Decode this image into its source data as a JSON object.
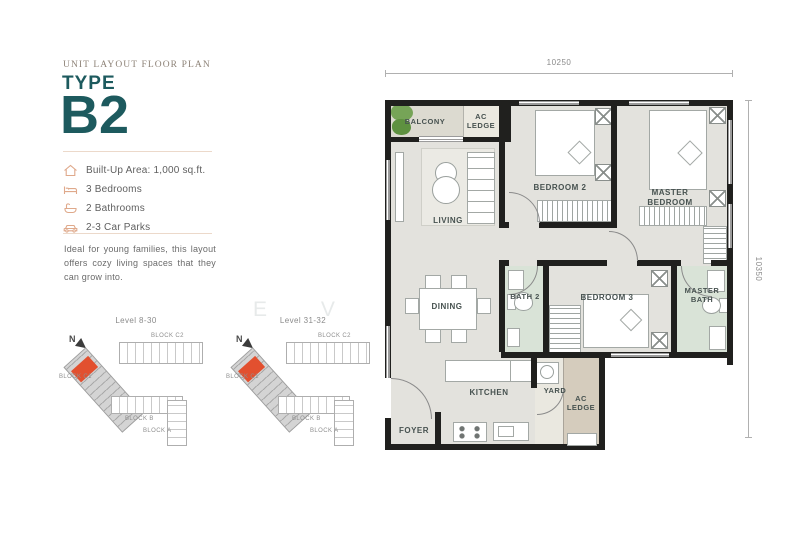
{
  "watermark": "E V A N S",
  "header": {
    "kicker": "UNIT LAYOUT FLOOR PLAN",
    "type_label": "TYPE",
    "unit_code": "B2"
  },
  "features": [
    {
      "icon": "house-icon",
      "text": "Built-Up Area: 1,000 sq.ft."
    },
    {
      "icon": "bed-icon",
      "text": "3 Bedrooms"
    },
    {
      "icon": "bath-icon",
      "text": "2 Bathrooms"
    },
    {
      "icon": "car-icon",
      "text": "2-3 Car Parks"
    }
  ],
  "description": "Ideal for young families, this layout offers cozy living spaces that they can grow into.",
  "site_maps": [
    {
      "level": "Level 8-30",
      "compass": "N",
      "blocks": {
        "c2": "BLOCK C2",
        "c1": "BLOCK C1",
        "b": "BLOCK B",
        "a": "BLOCK A"
      }
    },
    {
      "level": "Level 31-32",
      "compass": "N",
      "blocks": {
        "c2": "BLOCK C2",
        "c1": "BLOCK C1",
        "b": "BLOCK B",
        "a": "BLOCK A"
      }
    }
  ],
  "floor_plan": {
    "dim_top": "10250",
    "dim_right": "10350",
    "rooms": {
      "balcony": "BALCONY",
      "ac_ledge_top": "AC LEDGE",
      "living": "LIVING",
      "bedroom2": "BEDROOM 2",
      "master_bedroom": "MASTER BEDROOM",
      "dining": "DINING",
      "bath2": "BATH 2",
      "bedroom3": "BEDROOM 3",
      "master_bath": "MASTER BATH",
      "kitchen": "KITCHEN",
      "yard": "YARD",
      "ac_ledge_bottom": "AC LEDGE",
      "foyer": "FOYER"
    }
  },
  "colors": {
    "accent_teal": "#1d5a5e",
    "icon_salmon": "#dfa98b",
    "divider_peach": "#ecd9ca",
    "wall_black": "#20201e",
    "floor_grey": "#e3e2dd",
    "bath_green": "#d9e3d7",
    "ledge_tan": "#d5ccbd",
    "plant_green": "#76a457",
    "highlight_red": "#e2502f"
  }
}
